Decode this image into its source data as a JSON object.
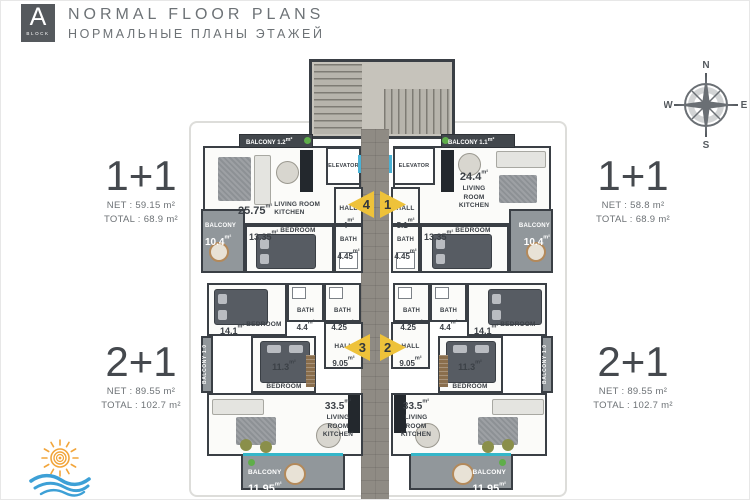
{
  "header": {
    "block_letter": "A",
    "block_word": "BLOCK",
    "title": "NORMAL FLOOR PLANS",
    "subtitle": "НОРМАЛЬНЫЕ ПЛАНЫ ЭТАЖЕЙ"
  },
  "compass": {
    "north": "N",
    "east": "E",
    "south": "S",
    "west": "W"
  },
  "specs": {
    "top_left": {
      "type": "1+1",
      "net": "NET : 59.15 m²",
      "total": "TOTAL : 68.9 m²"
    },
    "top_right": {
      "type": "1+1",
      "net": "NET : 58.8 m²",
      "total": "TOTAL : 68.9 m²"
    },
    "bottom_left": {
      "type": "2+1",
      "net": "NET : 89.55 m²",
      "total": "TOTAL : 102.7 m²"
    },
    "bottom_right": {
      "type": "2+1",
      "net": "NET : 89.55 m²",
      "total": "TOTAL : 102.7 m²"
    }
  },
  "plan": {
    "sqm": "m²",
    "elevator": "ELEVATOR",
    "arrows": {
      "unit4": "4",
      "unit1": "1",
      "unit3": "3",
      "unit2": "2"
    },
    "unit4": {
      "balcony_top": {
        "name": "BALCONY",
        "area": "1.2"
      },
      "living": {
        "area": "25.75",
        "name": "LIVING ROOM KITCHEN"
      },
      "hall": {
        "name": "HALL",
        "area": "4"
      },
      "bedroom": {
        "area": "13.35",
        "name": "BEDROOM"
      },
      "bath": {
        "name": "BATH",
        "area": "4.45"
      },
      "balcony_side": {
        "name": "BALCONY",
        "area": "10.4"
      }
    },
    "unit1": {
      "balcony_top": {
        "name": "BALCONY",
        "area": "1.1"
      },
      "living": {
        "area": "24.4",
        "name": "LIVING ROOM KITCHEN"
      },
      "hall": {
        "name": "HALL",
        "area": "5.1"
      },
      "bedroom": {
        "area": "13.35",
        "name": "BEDROOM"
      },
      "bath": {
        "name": "BATH",
        "area": "4.45"
      },
      "balcony_side": {
        "name": "BALCONY",
        "area": "10.4"
      }
    },
    "unit3": {
      "bedroom_large": {
        "area": "14.1",
        "name": "BEDROOM"
      },
      "bath_inner": {
        "name": "BATH",
        "area": "4.4"
      },
      "bath_outer": {
        "name": "BATH",
        "area": "4.25"
      },
      "hall": {
        "name": "HALL",
        "area": "9.05"
      },
      "bedroom_small": {
        "area": "11.3",
        "name": "BEDROOM"
      },
      "balcony_side": "BALCONY 1.0",
      "living": {
        "area": "33.5",
        "name": "LIVING ROOM KITCHEN"
      },
      "balcony_bottom": {
        "name": "BALCONY",
        "area": "11.95"
      }
    },
    "unit2": {
      "bath_outer": {
        "name": "BATH",
        "area": "4.25"
      },
      "bath_inner": {
        "name": "BATH",
        "area": "4.4"
      },
      "bedroom_large": {
        "area": "14.1",
        "name": "BEDROOM"
      },
      "hall": {
        "name": "HALL",
        "area": "9.05"
      },
      "bedroom_small": {
        "area": "11.3",
        "name": "BEDROOM"
      },
      "balcony_side": "BALCONY 1.0",
      "living": {
        "area": "33.5",
        "name": "LIVING ROOM KITCHEN"
      },
      "balcony_bottom": {
        "name": "BALCONY",
        "area": "11.95"
      }
    }
  }
}
